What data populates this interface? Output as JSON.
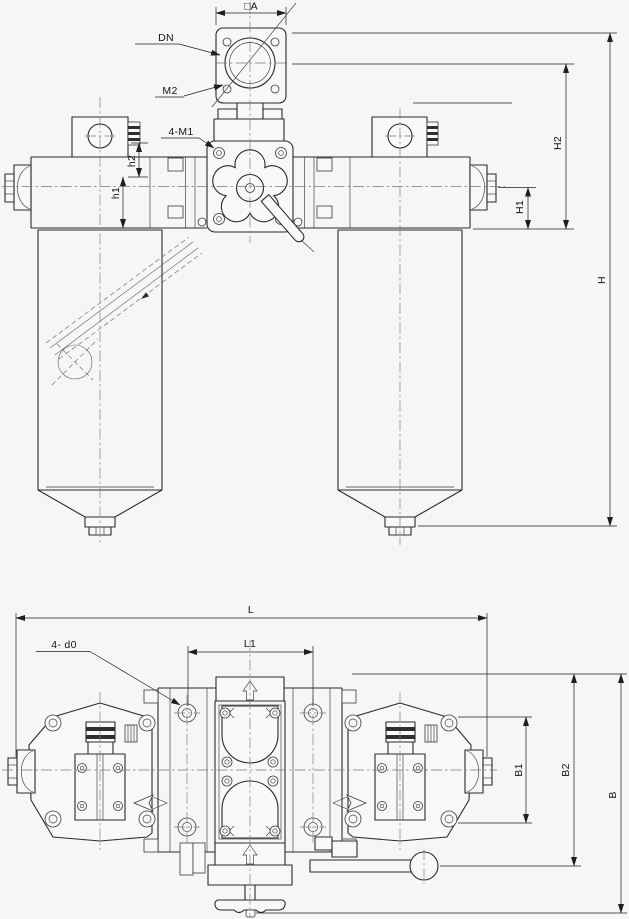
{
  "front": {
    "square_a": "□A",
    "dn": "DN",
    "m2": "M2",
    "m1": "4-M1",
    "h2": "h2",
    "h1": "h1",
    "H2": "H2",
    "H1": "H1",
    "H": "H"
  },
  "plan": {
    "L": "L",
    "L1": "L1",
    "d0": "4- d0",
    "B1": "B1",
    "B2": "B2",
    "B": "B"
  },
  "colors": {
    "outline": "#2a2a2a",
    "thin_line": "#3a3a3a",
    "centerline": "#787878",
    "background": "#f6f6f4"
  }
}
